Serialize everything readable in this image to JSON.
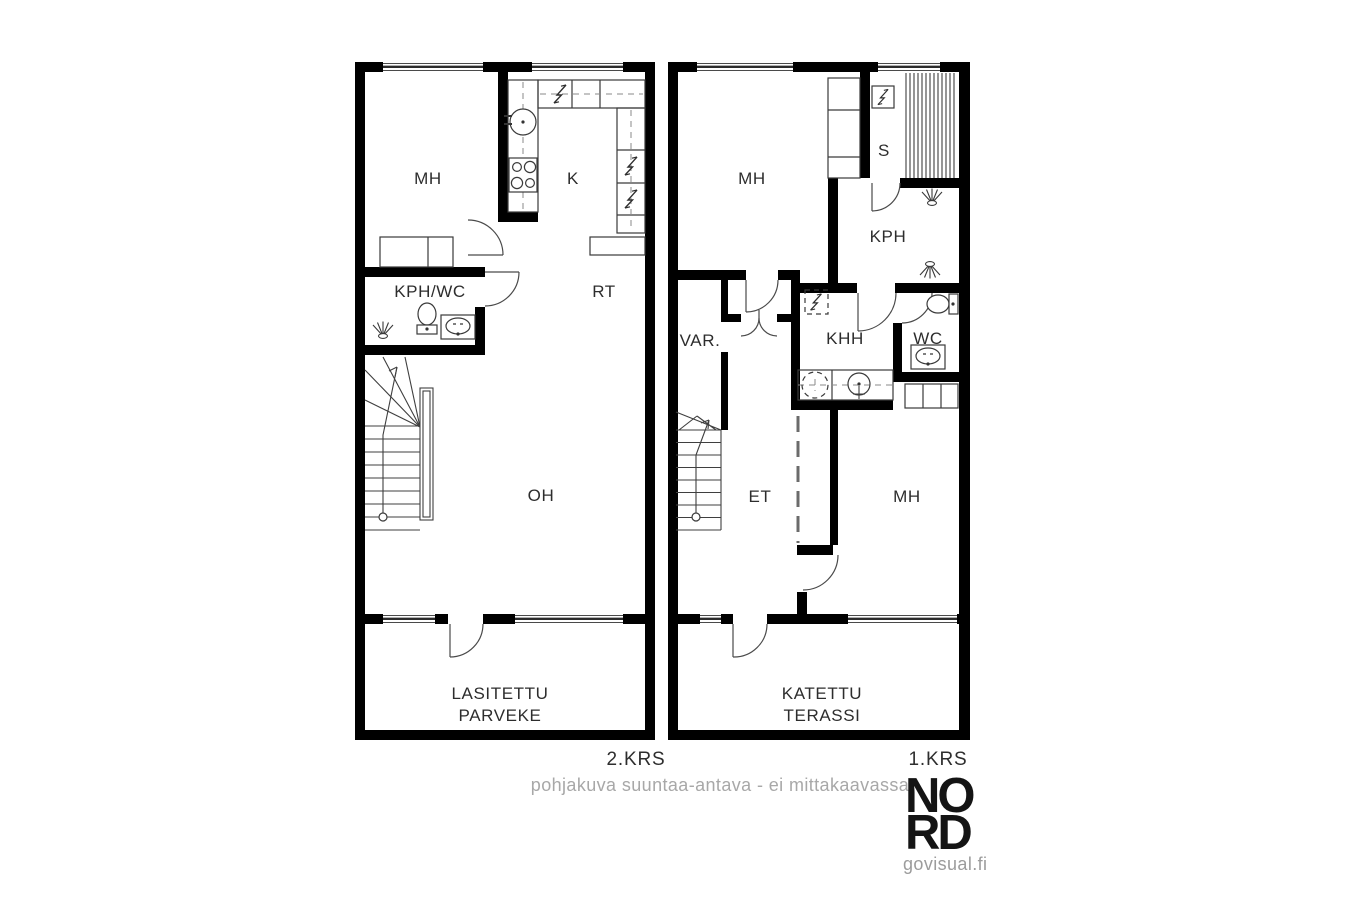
{
  "plans": {
    "left": {
      "floor_label": "2.KRS",
      "rooms": {
        "mh": "MH",
        "k": "K",
        "rt": "RT",
        "kph_wc": "KPH/WC",
        "oh": "OH",
        "balcony_line1": "LASITETTU",
        "balcony_line2": "PARVEKE"
      }
    },
    "right": {
      "floor_label": "1.KRS",
      "rooms": {
        "mh_top": "MH",
        "s": "S",
        "kph": "KPH",
        "var": "VAR.",
        "khh": "KHH",
        "wc": "WC",
        "et": "ET",
        "mh_bottom": "MH",
        "terrace_line1": "KATETTU",
        "terrace_line2": "TERASSI"
      }
    }
  },
  "footer": {
    "note": "pohjakuva suuntaa-antava - ei mittakaavassa"
  },
  "branding": {
    "logo_line1": "NO",
    "logo_line2": "RD",
    "website": "govisual.fi"
  },
  "colors": {
    "wall": "#000000",
    "thin_line": "#3f3f3f",
    "note_gray": "#a8a8a8",
    "label": "#2d2d2d"
  },
  "icons": {
    "appliance": "lightning-bolt-icon",
    "shower": "spray-fan-icon",
    "toilet": "wc-bowl-icon",
    "sink": "basin-icon",
    "washing_machine": "dashed-drum-icon",
    "stove": "four-burner-icon",
    "stairs": "treads-direction-arrow"
  }
}
